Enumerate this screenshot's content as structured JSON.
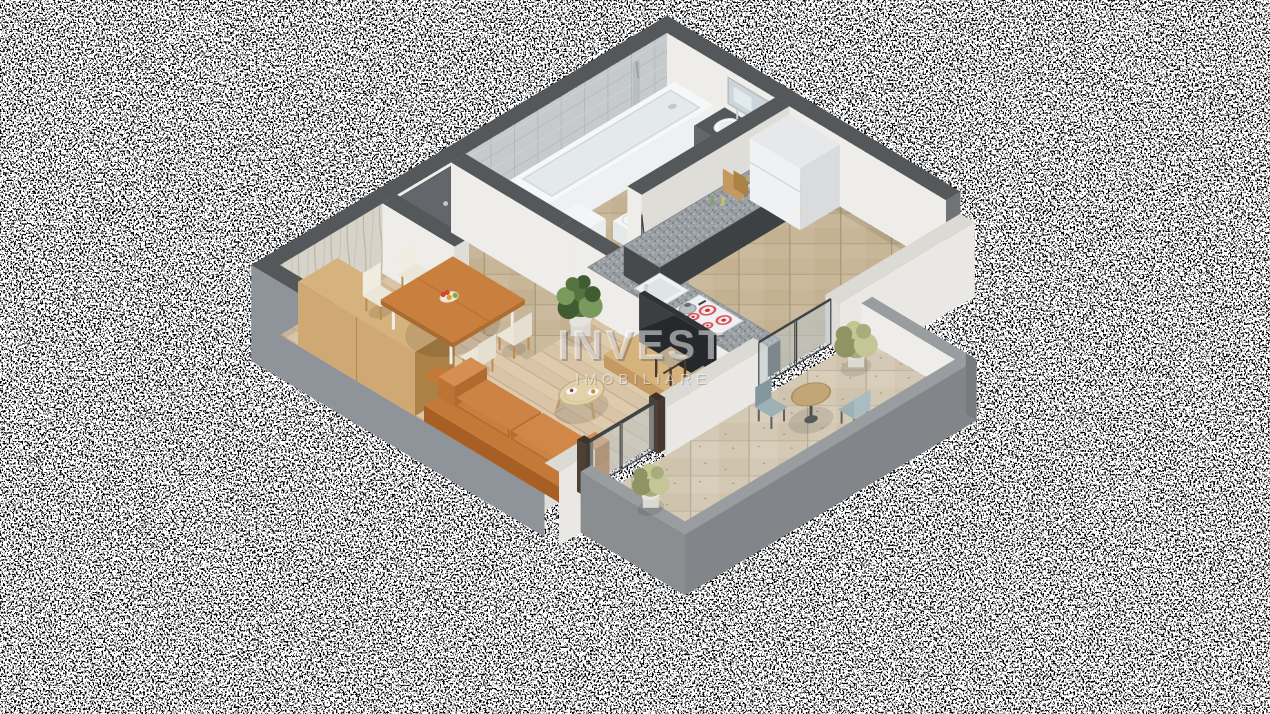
{
  "watermark": {
    "line1": "INVEST",
    "line2": "IMOBILIARE"
  },
  "scene": {
    "type": "isometric-3d-floorplan-render",
    "background": "transparency-noise",
    "rooms": [
      "living-room",
      "dining-area",
      "hallway",
      "bathroom",
      "kitchen",
      "balcony"
    ],
    "furniture": [
      "orange-sofa",
      "coffee-table",
      "dining-table",
      "dining-chairs",
      "fruit-bowl",
      "wardrobe",
      "tv",
      "tv-stand",
      "bar-stools",
      "kitchen-counter",
      "cooktop",
      "kettle",
      "kitchen-sink",
      "fridge",
      "cutting-boards",
      "bathtub",
      "shower-column",
      "vanity-sink",
      "mirror",
      "washing-machine",
      "toilet",
      "entry-door",
      "bathroom-glass-door",
      "balcony-glass-doors",
      "bistro-table",
      "balcony-chairs",
      "potted-plants"
    ]
  },
  "palette": {
    "wallTop": "#54585b",
    "wallFaceL": "#8f939a",
    "wallFaceD": "#6f7377",
    "wallWhite": "#efede9",
    "wallWhiteShade": "#dfddd8",
    "wallpaperBase": "#d8d3c9",
    "tileWallBase": "#c6cacd",
    "woodBase": "#dac4a7",
    "tileBase": "#c7b698",
    "travBase": "#d4c9b5",
    "granite": "#9ba0a4",
    "cabinetDark": "#46494c",
    "white": "#f2f4f5",
    "whiteShade": "#dde2e4",
    "steel": "#c9cdd0",
    "sofa": "#c47938",
    "sofaDark": "#a75f24",
    "sofaLight": "#d68f50",
    "woodFurn": "#c49a62",
    "woodFurnDark": "#ab8145",
    "woodFurnLight": "#d6b27d",
    "cream": "#eae6d8",
    "chairLeg": "#b98e4f",
    "tvDark": "#26292c",
    "glass": "rgba(185,198,203,0.5)",
    "frameDark": "#3f4346",
    "doorGray": "#63676b",
    "plantDark": "#3f5c33",
    "plant": "#567441",
    "plantLight": "#7a9a5d",
    "olive": "#a9ac7c",
    "oliveLight": "#c4c795",
    "oliveDark": "#8e9464",
    "pot": "#dcd9d2",
    "potShade": "#c6c3bb",
    "red": "#c9393f",
    "redLight": "#e0565c",
    "blueChair": "#9db2b7",
    "blueChairDark": "#83989e",
    "mirror": "#ccd5d9",
    "fridgeFace": "#eff1f2",
    "fridgeSide": "#d9dbdc",
    "parapetTop": "#9a9da0",
    "parapetFace": "#82868a",
    "fascia": "#6b6f72",
    "watermarkColor": "rgba(255,255,255,0.5)"
  }
}
